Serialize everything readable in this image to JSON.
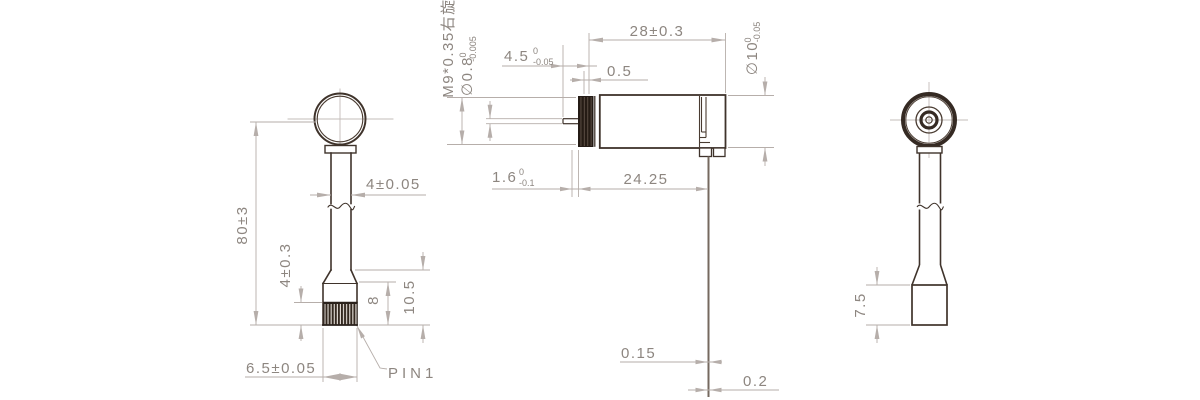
{
  "drawing": {
    "background": "#ffffff",
    "outline_color": "#3f332b",
    "dark_fill_color": "#241b16",
    "dimension_line_color": "#b6aeaa",
    "dimension_text_color": "#8d8680"
  },
  "left_view": {
    "dims": {
      "overall_height": "80±3",
      "shaft_width": "4±0.05",
      "knurl_height": "4±0.3",
      "grip_height": "8",
      "lower_height": "10.5",
      "base_width": "6.5±0.05"
    },
    "pin_label": "PIN1"
  },
  "middle_view": {
    "dims": {
      "thread_spec": "M9*0.35右旋",
      "shaft_diameter": {
        "main": "∅0.8",
        "sup": "0",
        "sub": "-0.005"
      },
      "shaft_length": {
        "main": "4.5",
        "sup": "0",
        "sub": "-0.05"
      },
      "front_gap": "0.5",
      "body_length": "28±0.3",
      "body_diameter": {
        "main": "∅10",
        "sup": "0",
        "sub": "-0.05"
      },
      "nut_thickness": {
        "main": "1.6",
        "sup": "0",
        "sub": "-0.1"
      },
      "case_length": "24.25",
      "terminal_thickness": "0.15",
      "terminal_tip_thickness": "0.2"
    }
  },
  "right_view": {
    "dims": {
      "base_height": "7.5"
    }
  }
}
